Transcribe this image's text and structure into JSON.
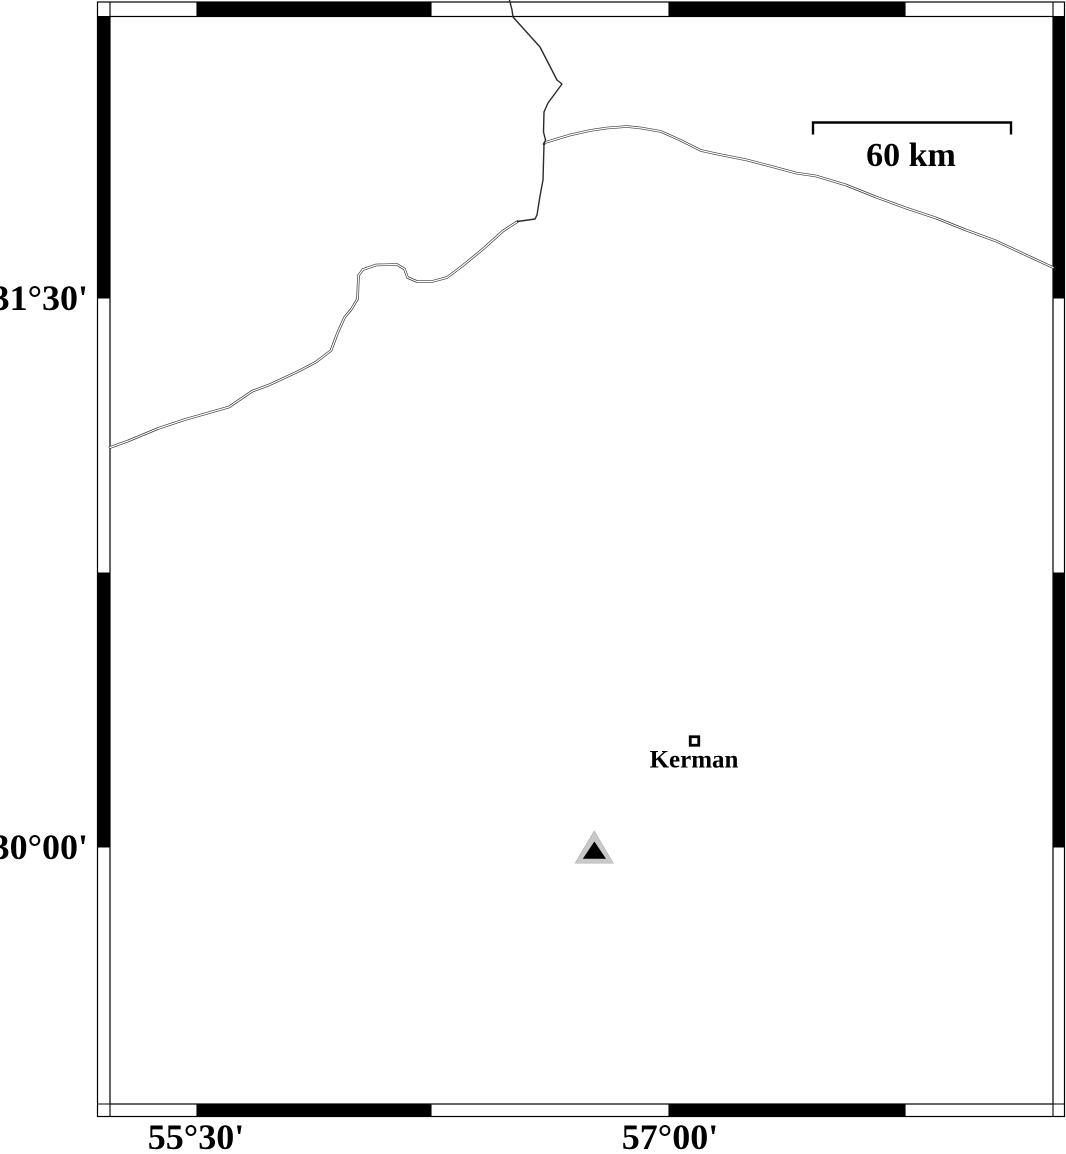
{
  "map": {
    "kind": "geographic-map-figure",
    "frame_style": "fancy-alternating-black-white",
    "colors": {
      "frame_black": "#000000",
      "background": "#ffffff",
      "road_line": "#3a3a3a",
      "triangle_fill": "#c9c9c9",
      "triangle_inner_fill": "#000000"
    },
    "lat_ticks": [
      {
        "label": "31°30'"
      },
      {
        "label": "30°00'"
      }
    ],
    "lon_ticks": [
      {
        "label": "55°30'"
      },
      {
        "label": "57°00'"
      }
    ],
    "scale_bar": {
      "label": "60 km"
    },
    "city_marker": {
      "label": "Kerman",
      "symbol": "open-square"
    },
    "epicenter_marker": {
      "symbol": "filled-triangle-with-inner-triangle"
    }
  }
}
